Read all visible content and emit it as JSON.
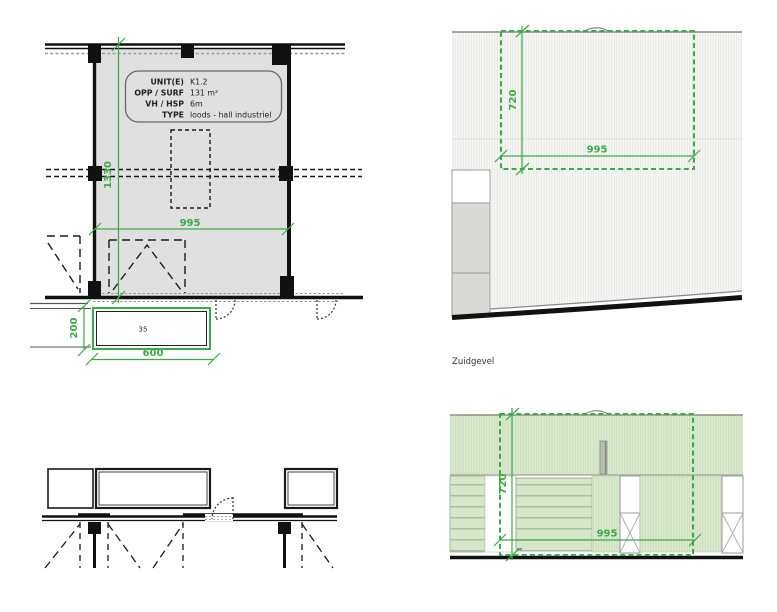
{
  "colors": {
    "accent_green": "#3caa46",
    "plan_fill": "#e0e0e0",
    "wall": "#111111"
  },
  "plan": {
    "info": {
      "rows": [
        {
          "label": "UNIT(E)",
          "value": "K1.2"
        },
        {
          "label": "OPP / SURF",
          "value": "131 m²"
        },
        {
          "label": "VH / HSP",
          "value": "6m"
        },
        {
          "label": "TYPE",
          "value": "loods - hall industriel"
        }
      ]
    },
    "dim_height": "1330",
    "dim_width": "995",
    "plinth": {
      "label": "35",
      "dim_width": "600",
      "dim_height": "200"
    }
  },
  "south_elevation": {
    "caption": "Zuidgevel",
    "dim_height": "720",
    "dim_width": "995"
  },
  "rear_elevation": {
    "dim_height": "720",
    "dim_width": "995"
  }
}
